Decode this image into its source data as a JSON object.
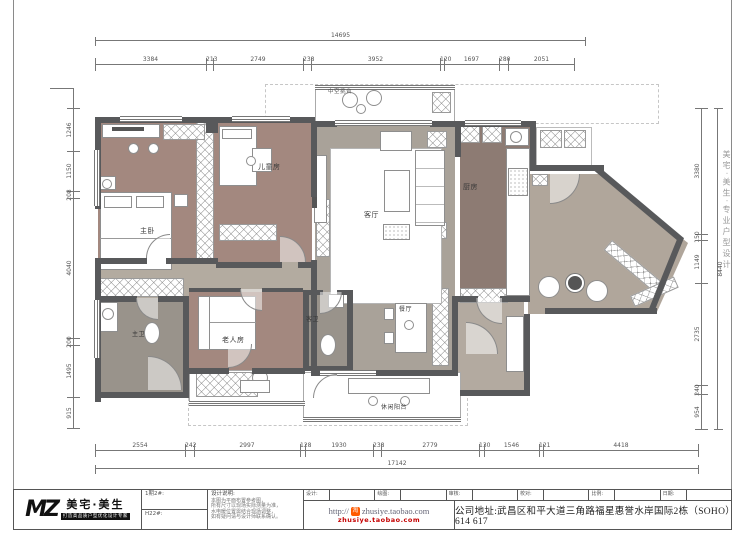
{
  "sheet": {
    "watermark_right": "美宅·美生·专业户型设计",
    "colors": {
      "wall": "#58595b",
      "bedroom_floor": "#a3887f",
      "living_floor": "#a9a299",
      "kitchen_floor": "#8d7b73",
      "bath_floor": "#99938b",
      "corridor_floor": "#b3aba0",
      "accent_red": "#c40000",
      "taobao_orange": "#ff5a00"
    }
  },
  "rooms": {
    "master_bedroom": "主卧",
    "children_room": "儿童房",
    "living_room": "客厅",
    "kitchen": "厨房",
    "dining_room": "餐厅",
    "leisure_balcony": "休闲阳台",
    "master_bath": "主卫",
    "elder_room": "老人房",
    "guest_bath": "客卫",
    "top_balcony": "中空挑台"
  },
  "dims": {
    "top": {
      "total": "14695",
      "segments": [
        "3384",
        "213",
        "2749",
        "238",
        "3952",
        "120",
        "1697",
        "280",
        "2051"
      ]
    },
    "bottom": {
      "total": "17142",
      "segments": [
        "2554",
        "242",
        "2997",
        "128",
        "1930",
        "238",
        "2779",
        "130",
        "1546",
        "121",
        "4418"
      ]
    },
    "left": {
      "segments": [
        "1246",
        "1150",
        "208",
        "4040",
        "200",
        "1495",
        "915"
      ]
    },
    "right": {
      "total": "8440",
      "segments": [
        "3380",
        "150",
        "1149",
        "2735",
        "240",
        "954"
      ]
    }
  },
  "titleblock": {
    "logo_mark": "MZ",
    "logo_name": "美宅·美生",
    "logo_slogan": "打造高品质户型优化设计专家",
    "field1": "1期2#:",
    "field2": "H22#:",
    "notes_title": "设计说明:",
    "notes_lines": [
      "本图为平面布置参考图，",
      "所有尺寸以现场实际测量为准，",
      "水电暖位置需结合现场调整，",
      "如有疑问请与设计师联系确认。"
    ],
    "fields": [
      "设计:",
      "绘图:",
      "审核:",
      "校对:",
      "比例:",
      "日期:"
    ],
    "url_prefix": "http://",
    "url_main": "zhusiye.taobao.com",
    "url_sub": "zhusiye.taobao.com",
    "address": "公司地址:武昌区和平大道三角路福星惠誉水岸国际2栋（SOHO）614 617"
  }
}
